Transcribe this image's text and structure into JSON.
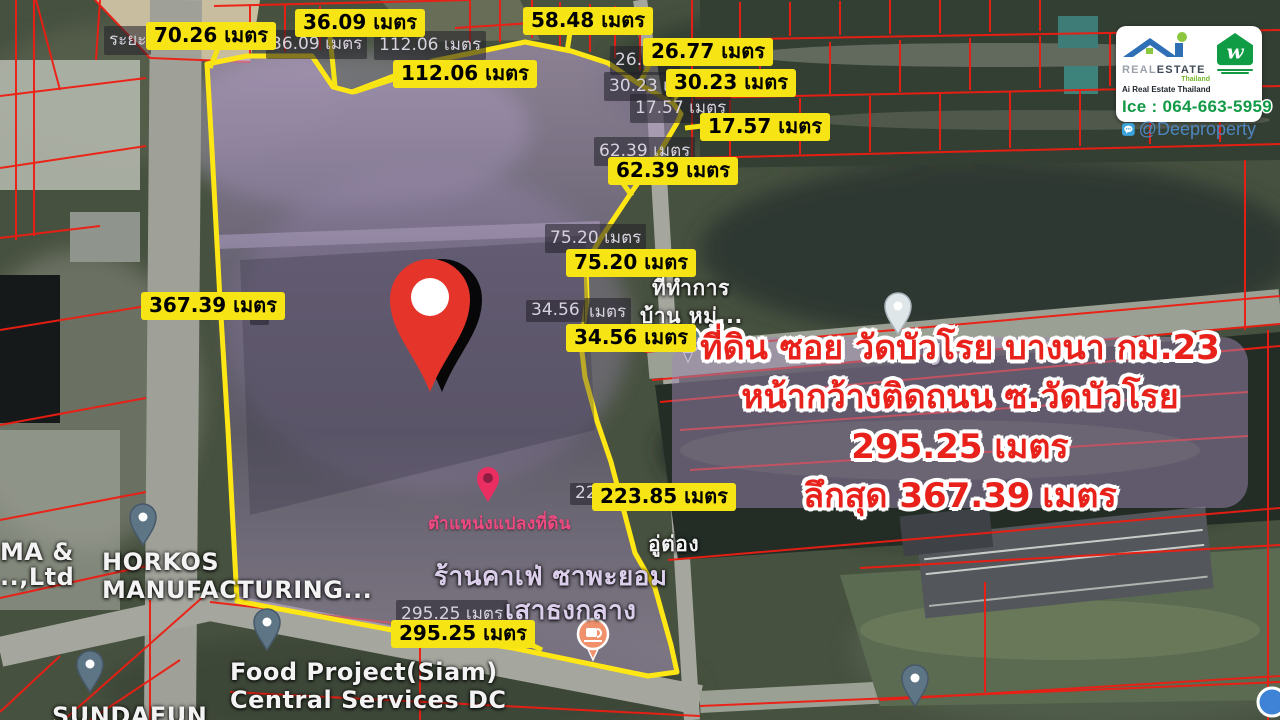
{
  "info_box": {
    "line1": "ที่ดิน ซอย วัดบัวโรย บางนา กม.23",
    "line2": "หน้ากว้างติดถนน ซ.วัดบัวโรย 295.25 เมตร",
    "line3": "ลึกสุด 367.39 เมตร"
  },
  "branding": {
    "real": "REAL",
    "estate": "ESTATE",
    "thailand": "Thailand",
    "tagline": "Ai Real Estate Thailand",
    "phone": "Ice : 064-663-5959",
    "line_id": "@Deeproperty"
  },
  "callouts": [
    {
      "text": "70.26 เมตร"
    },
    {
      "text": "36.09 เมตร"
    },
    {
      "text": "112.06 เมตร"
    },
    {
      "text": "58.48 เมตร"
    },
    {
      "text": "26.77 เมตร"
    },
    {
      "text": "30.23 เมตร"
    },
    {
      "text": "17.57 เมตร"
    },
    {
      "text": "62.39 เมตร"
    },
    {
      "text": "75.20 เมตร"
    },
    {
      "text": "34.56 เมตร"
    },
    {
      "text": "367.39 เมตร"
    },
    {
      "text": "223.85 เมตร"
    },
    {
      "text": "295.25 เมตร"
    }
  ],
  "map_measurements": [
    {
      "text": "ระยะ"
    },
    {
      "text": "36.09 เมตร"
    },
    {
      "text": "112.06 เมตร"
    },
    {
      "text": "26.77 เ"
    },
    {
      "text": "30.23 เ"
    },
    {
      "text": "17.57 เมตร"
    },
    {
      "text": "62.39 เมตร"
    },
    {
      "text": "75.20 เมตร"
    },
    {
      "text": "34.56"
    },
    {
      "text": "เมตร"
    },
    {
      "text": "22"
    },
    {
      "text": "295.25 เมตร"
    },
    {
      "text": "ร"
    }
  ],
  "map_places": [
    {
      "text": "Mr.TJ"
    },
    {
      "text": "ที่ทำการ"
    },
    {
      "text": "บ้าน หมู่..."
    },
    {
      "text": "HORKOS"
    },
    {
      "text": "MANUFACTURING..."
    },
    {
      "text": "MA &"
    },
    {
      "text": "..,Ltd"
    },
    {
      "text": "Food Project(Siam)"
    },
    {
      "text": "Central Services DC"
    },
    {
      "text": "SUNDAFUN"
    },
    {
      "text": "ร้านคาเฟ่ ซาพะยอม"
    },
    {
      "text": "เสาธงกลาง"
    },
    {
      "text": "อู่ต่อง"
    },
    {
      "text": "ตำแหน่งแปลงที่ดิน"
    }
  ],
  "colors": {
    "callout_bg": "#f6e414",
    "plot_outline": "#ffe715",
    "plot_fill": "#9b7fb8",
    "parcel_line": "#ee1d12",
    "info_text": "#e8211b",
    "phone_green": "#139a46",
    "line_blue": "#4e86c0"
  }
}
